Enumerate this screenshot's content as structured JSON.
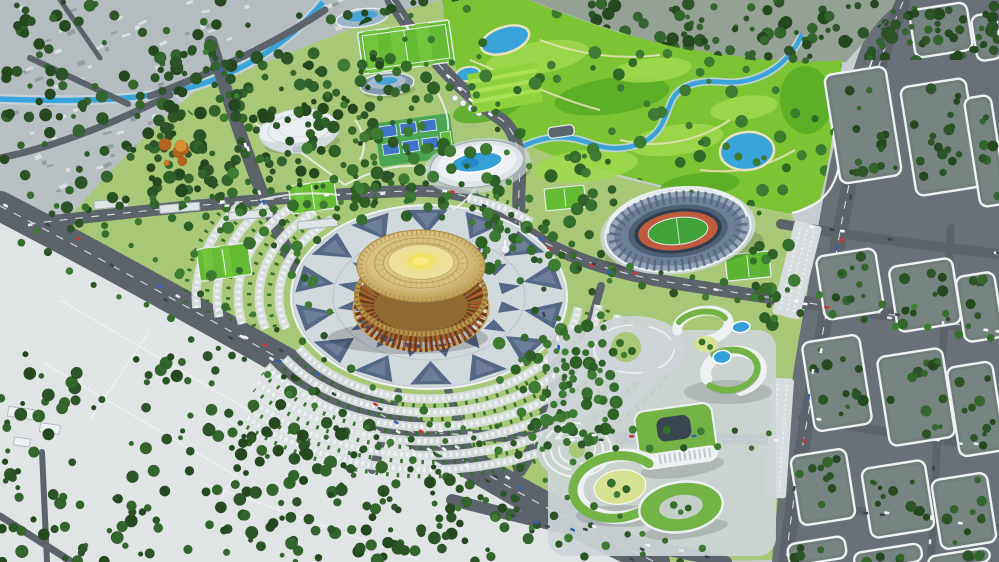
{
  "scene": {
    "alt_text": "Aerial 3D architectural rendering of a sports park master plan: golden circular arena on a patterned plaza ring, open-air stadium, aquatic center, white dome hall, golf course with ponds, green-roof campus buildings, tree-filled city blocks and wide boulevards with cars",
    "visible_text": [],
    "palette": {
      "base": "#c7ccd0",
      "terrain": "#e0e4e5",
      "cityGray": "#b5bcc0",
      "speckleLight": "#e6e9ea",
      "speckleDark": "#8c9499",
      "parkGreen": "#a8c878",
      "parkPath": "#eef1ee",
      "golfGreen": "#7cc434",
      "golfLight": "#9fd94e",
      "golfDark": "#58ab26",
      "golfTan": "#e4e0b4",
      "treeDark": "#2b5527",
      "treeDark2": "#24491f",
      "treeDark3": "#33662c",
      "treeMid": "#366e2d",
      "treeMid2": "#2e6126",
      "treeMid3": "#3f7c33",
      "treeGolf": "#2f6b28",
      "treeGolf2": "#3a7d30",
      "water": "#38a4da",
      "waterBank": "#c2d2d8",
      "neBase": "#95a194",
      "road": "#5d636a",
      "roadLine": "#eef0f2",
      "blockBase": "#717d7b",
      "blockLine": "#eef1f2",
      "streetBase": "#6a7077",
      "plaza": "#d2d9dd",
      "plazaTri": "#43587a",
      "plazaTri2": "#7d8ea8",
      "paving": "#cdd4d7",
      "gold": "#caa558",
      "goldDark": "#9c7838",
      "goldLight": "#e6d193",
      "domeTan": "#d9c28a",
      "disc": "#ecdf9f",
      "sun": "#f2e159",
      "sunCore": "#f6ec83",
      "drum": "#8f6b33",
      "drumDark": "#6e3a1d",
      "drumGlow": "#c05f28",
      "stadiumOuter": "#93a4b7",
      "stadiumMid": "#6e8099",
      "stadiumInner": "#4e6076",
      "stadiumOpen": "#2f3d4f",
      "pitch": "#3fa23a",
      "track": "#bf5c3e",
      "pool": "#35a0d8",
      "roofGreen": "#74b447",
      "lawnYellow": "#d6e292",
      "facade": "#eef1f3",
      "facadeShade": "#9aa6ae",
      "carA": "#f2f4f5",
      "carB": "#e4e7e9",
      "carC": "#3c444d",
      "carD": "#c43a30",
      "carE": "#2f62b8"
    },
    "speckles": [
      {
        "clip": "clip-city",
        "x": 0,
        "y": 0,
        "w": 460,
        "h": 210,
        "count": 170
      },
      {
        "clip": "clip-ne",
        "x": 530,
        "y": 0,
        "w": 468,
        "h": 60,
        "count": 45
      }
    ],
    "tree_clusters": [
      {
        "id": "city-tl-a",
        "x": 0,
        "y": 0,
        "w": 460,
        "h": 118,
        "count": 120,
        "shade": "dark",
        "clip": "clip-city"
      },
      {
        "id": "city-tl-b",
        "x": 0,
        "y": 100,
        "w": 220,
        "h": 110,
        "count": 50,
        "shade": "dark",
        "clip": "clip-city"
      },
      {
        "id": "nw-dense",
        "x": 148,
        "y": 52,
        "w": 250,
        "h": 140,
        "count": 145,
        "shade": "dark",
        "clip": null
      },
      {
        "id": "ne-city",
        "x": 528,
        "y": 0,
        "w": 470,
        "h": 62,
        "count": 150,
        "shade": "dark",
        "clip": "clip-ne"
      },
      {
        "id": "golf",
        "x": 452,
        "y": 4,
        "w": 400,
        "h": 205,
        "count": 85,
        "shade": "golf",
        "clip": "clip-golf"
      },
      {
        "id": "park-nw",
        "x": 168,
        "y": 148,
        "w": 210,
        "h": 135,
        "count": 42,
        "shade": "mid",
        "clip": null
      },
      {
        "id": "park-n",
        "x": 296,
        "y": 58,
        "w": 150,
        "h": 95,
        "count": 36,
        "shade": "mid",
        "clip": null
      },
      {
        "id": "park-mid",
        "x": 330,
        "y": 148,
        "w": 185,
        "h": 75,
        "count": 38,
        "shade": "mid",
        "clip": null
      },
      {
        "id": "stadium-w",
        "x": 540,
        "y": 152,
        "w": 75,
        "h": 125,
        "count": 26,
        "shade": "mid",
        "clip": null
      },
      {
        "id": "stadium-e",
        "x": 752,
        "y": 198,
        "w": 48,
        "h": 145,
        "count": 18,
        "shade": "mid",
        "clip": null
      },
      {
        "id": "terrain-sw",
        "x": 0,
        "y": 352,
        "w": 460,
        "h": 210,
        "count": 200,
        "shade": "dark",
        "clip": "clip-terrain"
      },
      {
        "id": "south-mid",
        "x": 235,
        "y": 425,
        "w": 300,
        "h": 137,
        "count": 100,
        "shade": "dark",
        "clip": "clip-terrain"
      },
      {
        "id": "park-se",
        "x": 498,
        "y": 318,
        "w": 120,
        "h": 125,
        "count": 45,
        "shade": "mid",
        "clip": null
      },
      {
        "id": "campus-w",
        "x": 540,
        "y": 330,
        "w": 75,
        "h": 105,
        "count": 26,
        "shade": "mid",
        "clip": null
      },
      {
        "id": "plaza-ne",
        "x": 478,
        "y": 214,
        "w": 72,
        "h": 62,
        "count": 18,
        "shade": "mid",
        "clip": null
      },
      {
        "id": "autumn",
        "x": 162,
        "y": 140,
        "w": 34,
        "h": 26,
        "count": 6,
        "shade": "autumn",
        "clip": null
      }
    ],
    "street_tree_roads": [
      {
        "road": "road-north",
        "offset": 9,
        "spacing": 17
      },
      {
        "road": "road-west",
        "offset": 8,
        "spacing": 17
      },
      {
        "road": "road-ns",
        "offset": 9,
        "spacing": 16
      },
      {
        "road": "road-stadium-south",
        "offset": 9,
        "spacing": 16
      },
      {
        "road": "road-mid-east",
        "offset": 8,
        "spacing": 17
      },
      {
        "road": "road-se-corner",
        "offset": 8,
        "spacing": 19
      },
      {
        "road": "road-main",
        "offset": 21,
        "spacing": 14
      },
      {
        "road": "road-bldg-vert",
        "offset": 7,
        "spacing": 20
      }
    ],
    "car_roads": [
      {
        "road": "road-main",
        "count": 34
      },
      {
        "road": "road-north",
        "count": 10
      },
      {
        "road": "road-ns",
        "count": 9
      },
      {
        "road": "road-stadium-south",
        "count": 14
      },
      {
        "road": "road-mid-east",
        "count": 9
      },
      {
        "road": "road-east-vert",
        "count": 10
      },
      {
        "road": "road-east-h1",
        "count": 6
      },
      {
        "road": "road-east-h3",
        "count": 4
      },
      {
        "road": "road-east-h4",
        "count": 4
      },
      {
        "road": "road-east-vert2",
        "count": 4
      },
      {
        "road": "road-se-corner",
        "count": 7
      },
      {
        "road": "road-west",
        "count": 6
      }
    ],
    "parking": {
      "cx": 429,
      "cy": 297,
      "squash": 0.68,
      "treeOffset": 10,
      "bands": [
        {
          "r": 150,
          "segs": [
            [
              -75,
              -45
            ],
            [
              6,
              152
            ],
            [
              162,
              232
            ]
          ]
        },
        {
          "r": 170,
          "segs": [
            [
              4,
              150
            ],
            [
              164,
              230
            ]
          ]
        },
        {
          "r": 191,
          "segs": [
            [
              8,
              148
            ],
            [
              168,
              226
            ]
          ]
        },
        {
          "r": 212,
          "segs": [
            [
              12,
              146
            ],
            [
              172,
              222
            ]
          ]
        },
        {
          "r": 233,
          "segs": [
            [
              16,
              142
            ],
            [
              176,
              216
            ]
          ]
        },
        {
          "r": 254,
          "segs": [
            [
              24,
              136
            ]
          ]
        }
      ]
    },
    "plaza_rings": {
      "cx": 429,
      "cy": 297,
      "squash": 0.66,
      "rings": [
        {
          "n": 14,
          "rOuter": 134,
          "rInner": 97,
          "point": "in",
          "halfDeg": 9
        },
        {
          "n": 16,
          "rOuter": 93,
          "rInner": 73,
          "point": "out",
          "halfDeg": 7
        }
      ]
    },
    "sun": {
      "cx": 421,
      "cy": 261,
      "rays": 20,
      "rOuter": 27,
      "rInner": 10,
      "squash": 0.53
    },
    "golf_patches": [
      [
        537,
        58,
        52,
        16,
        -10,
        "light"
      ],
      [
        612,
        96,
        58,
        18,
        -8,
        "dark"
      ],
      [
        676,
        140,
        48,
        15,
        -8,
        "light"
      ],
      [
        488,
        108,
        36,
        13,
        -14,
        "dark"
      ],
      [
        586,
        166,
        52,
        16,
        -6,
        "light"
      ],
      [
        744,
        108,
        34,
        12,
        -8,
        "light"
      ],
      [
        806,
        100,
        26,
        34,
        -4,
        "dark"
      ],
      [
        652,
        70,
        40,
        12,
        -6,
        "light"
      ],
      [
        700,
        185,
        40,
        12,
        -6,
        "dark"
      ]
    ],
    "city_blocks": {
      "rot": -9,
      "list": [
        [
          832,
          70,
          62,
          110
        ],
        [
          908,
          82,
          66,
          110
        ],
        [
          972,
          96,
          27,
          110
        ],
        [
          820,
          252,
          60,
          64
        ],
        [
          893,
          262,
          64,
          66
        ],
        [
          960,
          274,
          39,
          66
        ],
        [
          808,
          338,
          58,
          90
        ],
        [
          883,
          352,
          66,
          90
        ],
        [
          953,
          364,
          46,
          90
        ],
        [
          795,
          452,
          56,
          70
        ],
        [
          866,
          464,
          64,
          70
        ],
        [
          936,
          476,
          56,
          70
        ],
        [
          788,
          540,
          58,
          22
        ],
        [
          854,
          548,
          68,
          18
        ],
        [
          928,
          552,
          62,
          14
        ],
        [
          912,
          6,
          58,
          48
        ],
        [
          974,
          14,
          25,
          46
        ]
      ]
    }
  }
}
